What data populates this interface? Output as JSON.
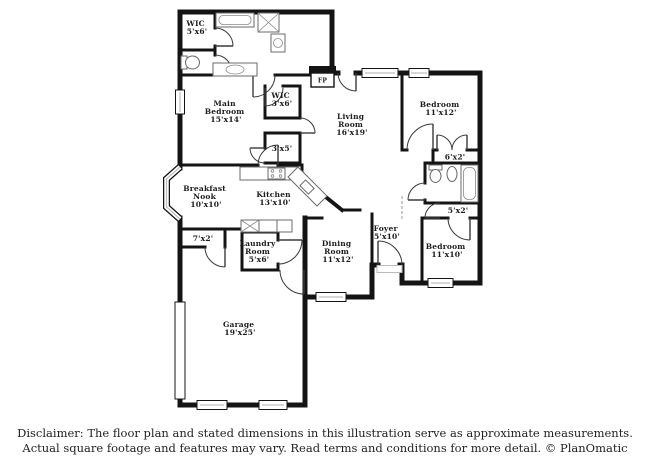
{
  "page": {
    "background": "#ffffff",
    "wall_color": "#141414",
    "window_line_color": "#bdbdbd"
  },
  "floor_plan": {
    "rooms": [
      {
        "label": "WIC 5'x6'",
        "lines": [
          "WIC",
          "5'x6'"
        ]
      },
      {
        "label": "WIC 3'x6'",
        "lines": [
          "WIC",
          "3'x6'"
        ]
      },
      {
        "label": "Main Bedroom 15'x14'",
        "lines": [
          "Main",
          "Bedroom",
          "15'x14'"
        ]
      },
      {
        "label": "Living Room 16'x19'",
        "lines": [
          "Living",
          "Room",
          "16'x19'"
        ]
      },
      {
        "label": "Bedroom 11'x12'",
        "lines": [
          "Bedroom",
          "11'x12'"
        ]
      },
      {
        "label": "6'x2'",
        "lines": [
          "6'x2'"
        ]
      },
      {
        "label": "3'x5'",
        "lines": [
          "3'x5'"
        ]
      },
      {
        "label": "Breakfast Nook 10'x10'",
        "lines": [
          "Breakfast",
          "Nook",
          "10'x10'"
        ]
      },
      {
        "label": "Kitchen 13'x10'",
        "lines": [
          "Kitchen",
          "13'x10'"
        ]
      },
      {
        "label": "5'x2'",
        "lines": [
          "5'x2'"
        ]
      },
      {
        "label": "Foyer 5'x10'",
        "lines": [
          "Foyer",
          "5'x10'"
        ]
      },
      {
        "label": "Bedroom 11'x10'",
        "lines": [
          "Bedroom",
          "11'x10'"
        ]
      },
      {
        "label": "7'x2'",
        "lines": [
          "7'x2'"
        ]
      },
      {
        "label": "Laundry Room 5'x6'",
        "lines": [
          "Laundry",
          "Room",
          "5'x6'"
        ]
      },
      {
        "label": "Dining Room 11'x12'",
        "lines": [
          "Dining",
          "Room",
          "11'x12'"
        ]
      },
      {
        "label": "Garage 19'x25'",
        "lines": [
          "Garage",
          "19'x25'"
        ]
      },
      {
        "label": "FP",
        "lines": [
          "FP"
        ]
      }
    ]
  },
  "footer": {
    "disclaimer_line1": "Disclaimer: The floor plan and stated dimensions in this illustration serve as approximate measurements.",
    "disclaimer_line2": "Actual square footage and features may vary. Read terms and conditions for more detail. © PlanOmatic"
  }
}
